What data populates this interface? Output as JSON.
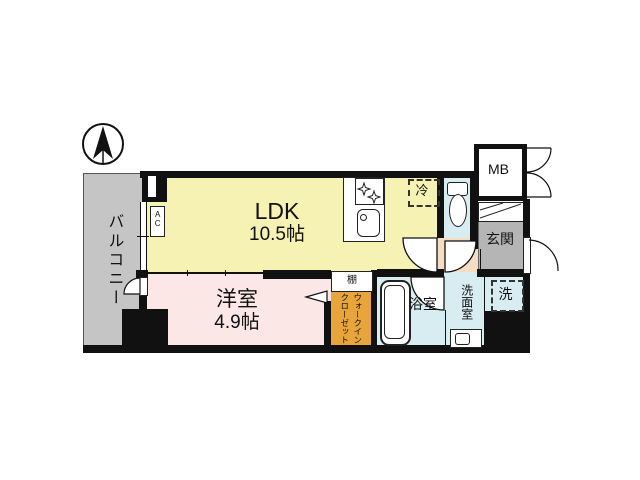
{
  "plan_title": "1LDK apartment floor plan",
  "rooms": {
    "balcony": {
      "label": "バルコニー"
    },
    "ldk": {
      "label": "LDK",
      "size": "10.5帖"
    },
    "western_room": {
      "label": "洋室",
      "size": "4.9帖"
    },
    "walk_in_closet": {
      "label_col1": "ウォークイン",
      "label_col2": "クローゼット"
    },
    "shelf": {
      "label": "棚"
    },
    "bathroom": {
      "label": "浴室"
    },
    "washroom": {
      "label": "洗面室"
    },
    "laundry": {
      "label": "洗"
    },
    "refrigerator": {
      "label": "冷"
    },
    "entrance": {
      "label": "玄関"
    },
    "meter_box": {
      "label": "MB"
    },
    "air_conditioner": {
      "label": "AC"
    }
  },
  "icons": {
    "compass": "north-arrow",
    "stove_burners": "four-point-stars",
    "toilet": "toilet-bowl-and-tank",
    "bathtub": "rounded-tub",
    "doors": "quarter-circle-swing-arcs"
  },
  "colors": {
    "wall": "#111111",
    "ldk_fill": "#f6f2b3",
    "western_room_fill": "#fbe7e5",
    "wic_fill": "#e8a53c",
    "wet_area_fill": "#d8edf2",
    "hallway_fill": "#f6dcc1",
    "balcony_fill": "#c5c5c5",
    "entrance_fill": "#b5b5b5"
  }
}
